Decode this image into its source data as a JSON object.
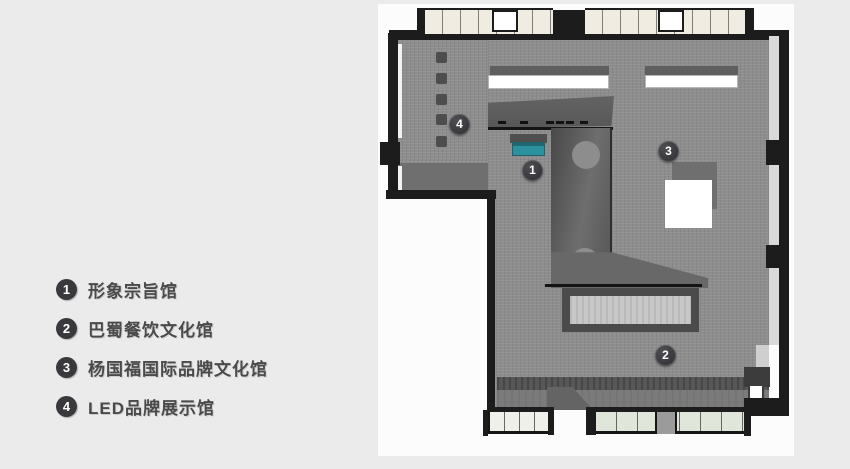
{
  "legend": {
    "items": [
      {
        "number": "1",
        "label": "形象宗旨馆"
      },
      {
        "number": "2",
        "label": "巴蜀餐饮文化馆"
      },
      {
        "number": "3",
        "label": "杨国福国际品牌文化馆"
      },
      {
        "number": "4",
        "label": "LED品牌展示馆"
      }
    ],
    "badge_color": "#39393d",
    "text_color": "#4a4a4a"
  },
  "floorplan": {
    "markers": [
      {
        "number": "1"
      },
      {
        "number": "2"
      },
      {
        "number": "3"
      },
      {
        "number": "4"
      }
    ],
    "colors": {
      "wall": "#1c1c1c",
      "floor": "#8d8d8d",
      "shadow": "#6f6f6f",
      "accent_teal": "#2b919e",
      "cabinet_cream": "#f0ece2",
      "cabinet_green": "#e0e7da",
      "table_inner": "#c7c7c7",
      "page_background": "#ebebeb",
      "card_background": "#fcfcfc"
    }
  }
}
